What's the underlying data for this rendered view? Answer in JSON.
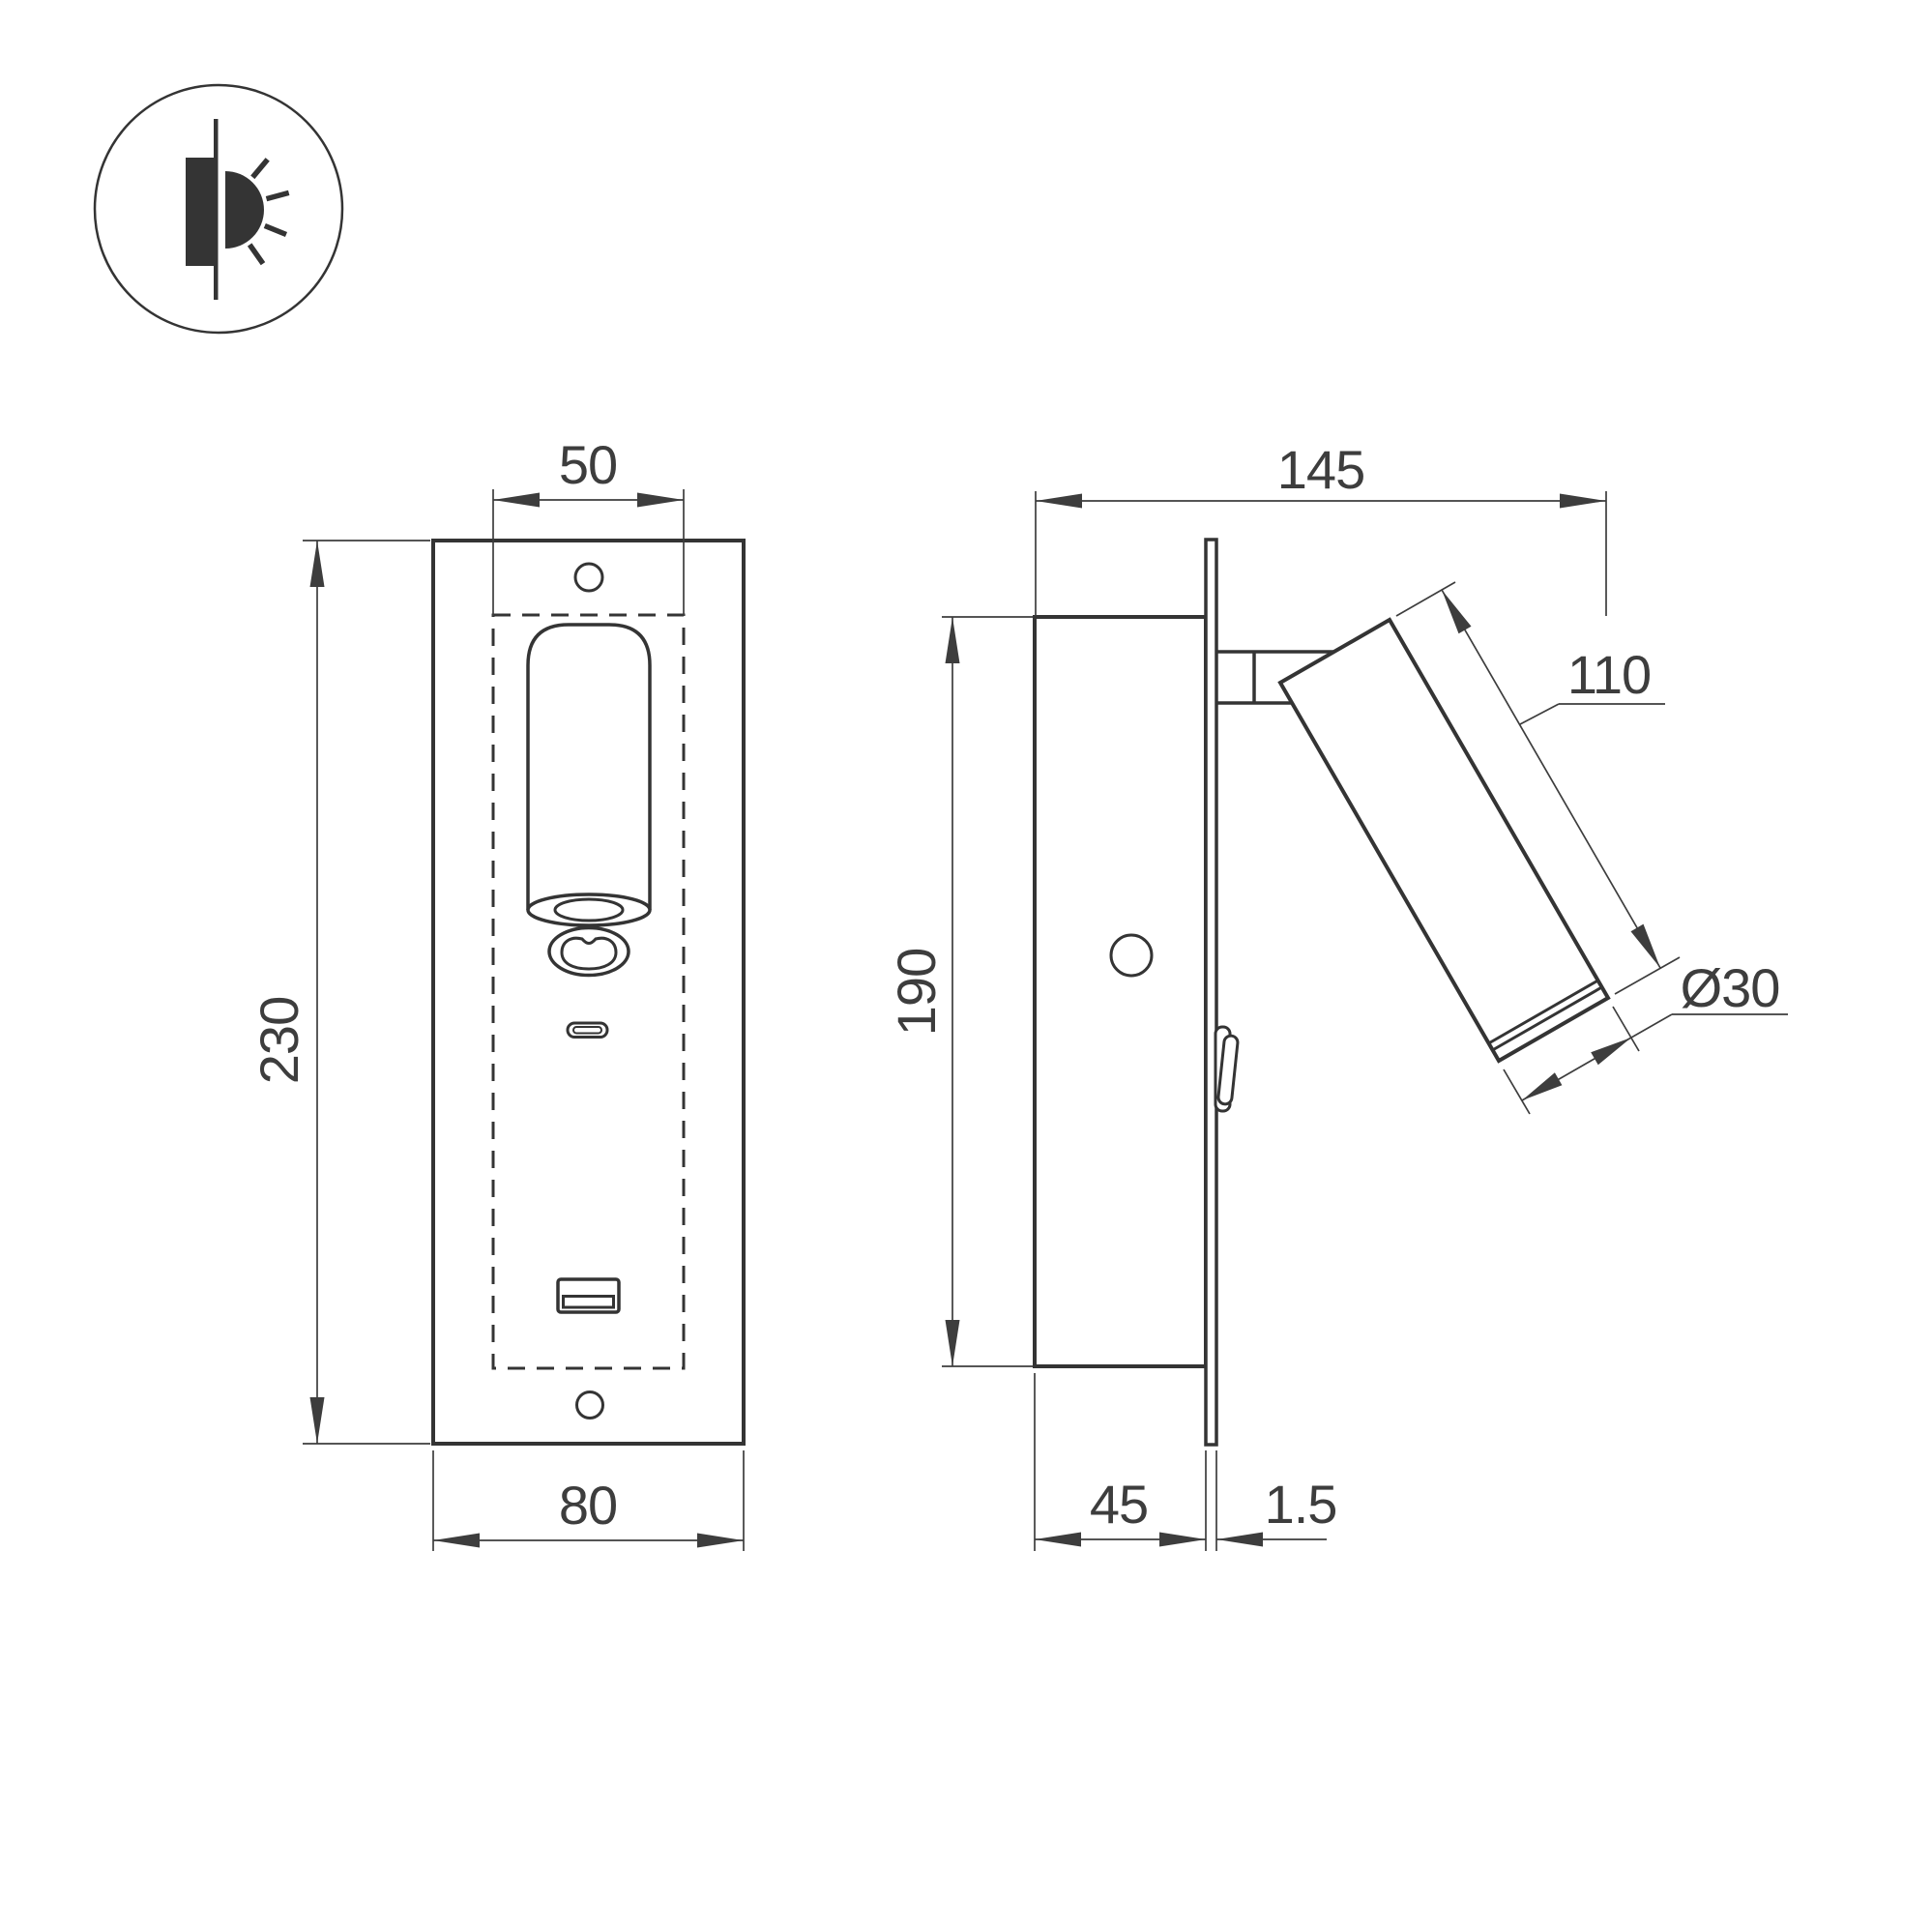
{
  "icon": {
    "name": "recessed-wall-light-symbol"
  },
  "labels": {
    "recess_width": "50",
    "plate_height": "230",
    "plate_width": "80",
    "total_depth": "145",
    "recess_height": "190",
    "spot_length": "110",
    "spot_diameter": "Ø30",
    "recess_depth": "45",
    "plate_thickness": "1.5"
  },
  "colors": {
    "line": "#343434",
    "dim": "#3d3d3d",
    "background": "#ffffff"
  }
}
